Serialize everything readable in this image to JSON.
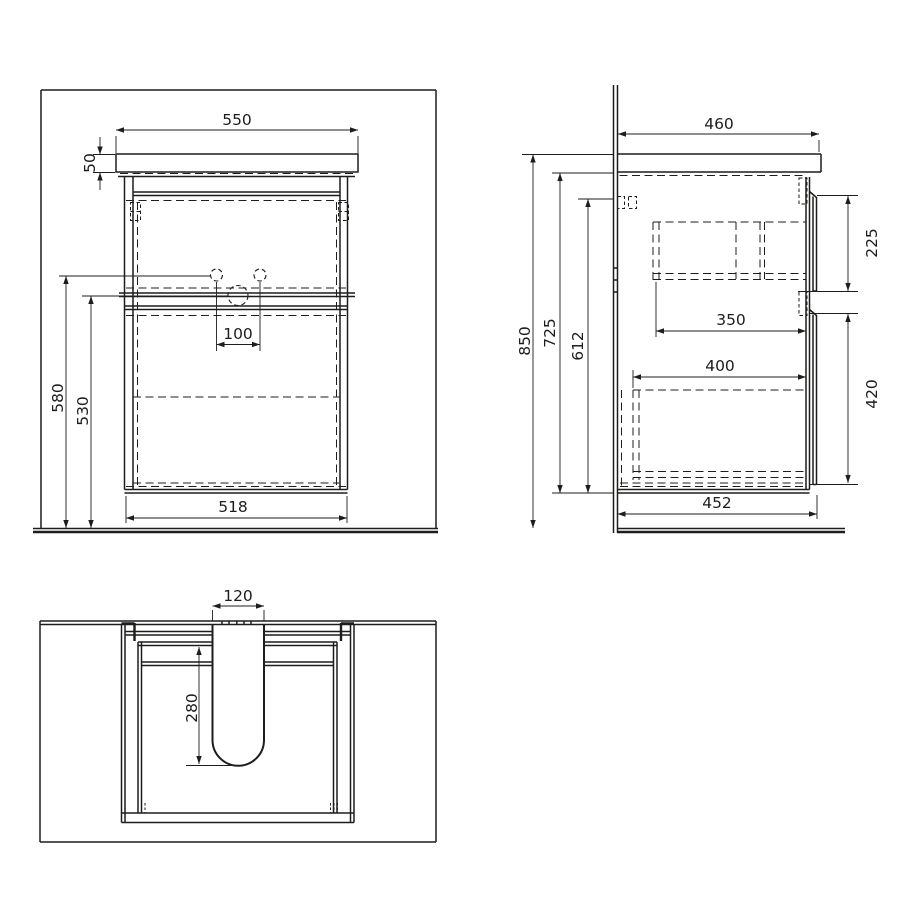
{
  "colors": {
    "background": "#ffffff",
    "line": "#1d1d1b"
  },
  "front_view": {
    "counter_width": "550",
    "counter_thickness": "50",
    "faucet_height": "580",
    "drain_height": "530",
    "faucet_spacing": "100",
    "cabinet_width": "518"
  },
  "side_view": {
    "counter_depth": "460",
    "upper_drawer_front": "225",
    "upper_drawer_depth": "350",
    "lower_drawer_depth": "400",
    "lower_drawer_front": "420",
    "overall_height": "850",
    "cabinet_height": "725",
    "hinge_height": "612",
    "cabinet_depth": "452"
  },
  "top_view": {
    "cutout_width": "120",
    "cutout_depth": "280"
  }
}
